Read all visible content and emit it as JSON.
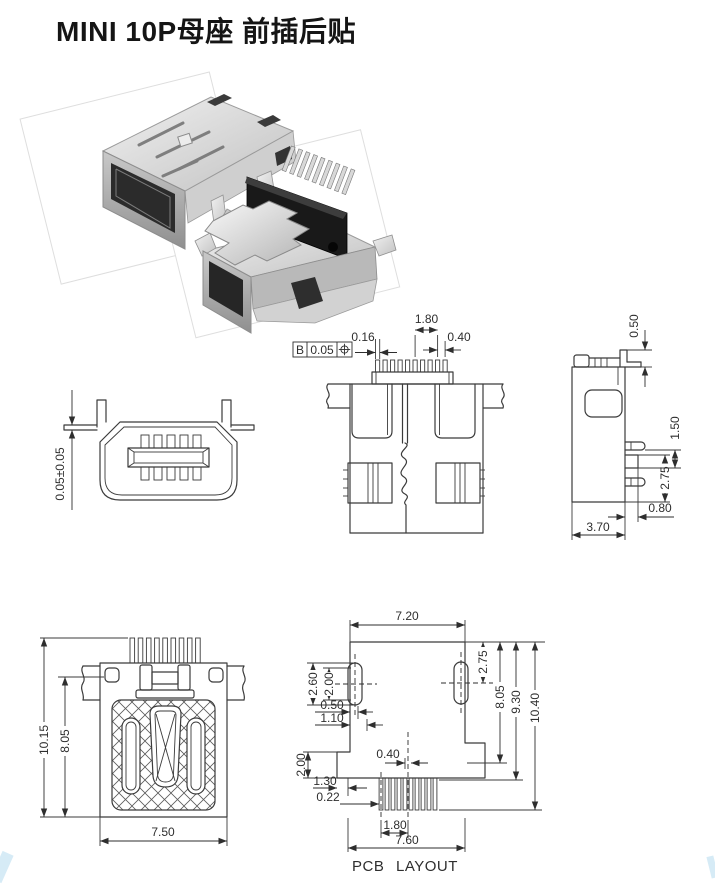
{
  "title": "MINI 10P母座 前插后贴",
  "caption": "PCB LAYOUT",
  "front_view": {
    "dims": {
      "coplanarity": "0.05±0.05"
    }
  },
  "bottom_view": {
    "fcf": {
      "datum": "B",
      "tolerance": "0.05",
      "symbol_icon": "position-tolerance-icon"
    },
    "dims": {
      "pin_width": "0.16",
      "group_pitch": "1.80",
      "pin_pitch": "0.40"
    }
  },
  "side_view": {
    "dims": {
      "tab_thickness": "0.50",
      "leg_step": "1.50",
      "leg_span": "2.75",
      "stub_length": "0.80",
      "depth": "3.70"
    }
  },
  "top_view": {
    "dims": {
      "overall_height": "10.15",
      "body_height": "8.05",
      "body_width": "7.50"
    }
  },
  "pcb_layout": {
    "dims": {
      "body_width": "7.20",
      "slot_center_offset": "2.75",
      "slot_length": "2.60",
      "slot_inner_length": "2.00",
      "slot_offset_a": "0.50",
      "slot_offset_b": "1.10",
      "flange_height": "2.00",
      "edge_step": "1.30",
      "pad_width": "0.22",
      "pad_offset": "0.40",
      "pad_group_pitch": "1.80",
      "footprint_width": "7.60",
      "depth_to_flange": "8.05",
      "depth_to_pads": "9.30",
      "overall_depth": "10.40"
    }
  }
}
